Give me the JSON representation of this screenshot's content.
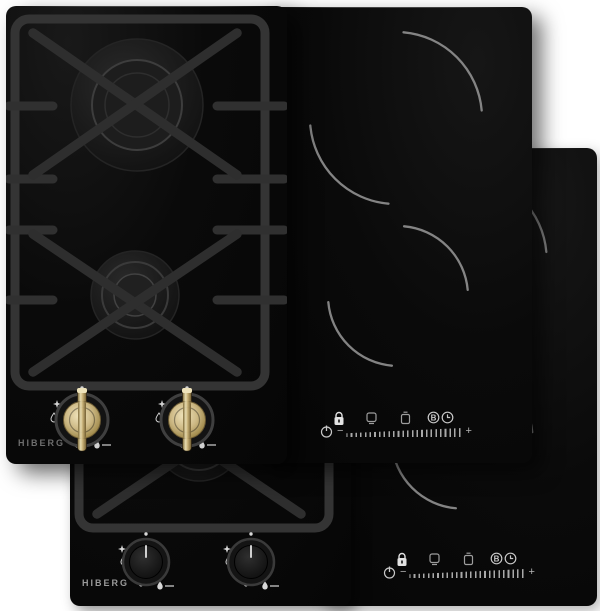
{
  "scene": {
    "background_color": "#ffffff",
    "layout": "two overlapping appliance sets, front pair upper-left, back pair offset lower-right"
  },
  "products": {
    "front_gas_hob": {
      "brand": "HIBERG",
      "type": "domino gas hob",
      "burners": 2,
      "knob_style": "brass",
      "knob_markings": [
        "off-dot",
        "spark-star",
        "droplet",
        "low-flame-dots",
        "small-flame",
        "max-flame-dash"
      ]
    },
    "front_induction_hob": {
      "type": "domino induction hob",
      "zones": 2,
      "controls": {
        "boost_label": "B",
        "minus_label": "−",
        "plus_label": "+",
        "icons": [
          "lock-icon",
          "zone-pot-1-icon",
          "zone-pot-2-icon",
          "boost-icon",
          "timer-icon",
          "power-icon",
          "level-slider"
        ]
      }
    },
    "back_gas_hob": {
      "brand": "HIBERG",
      "type": "domino gas hob",
      "burners": 2,
      "knob_style": "black"
    },
    "back_induction_hob": {
      "type": "domino induction hob",
      "zones": 2,
      "controls": {
        "boost_label": "B",
        "minus_label": "−",
        "plus_label": "+",
        "icons": [
          "lock-icon",
          "zone-pot-1-icon",
          "zone-pot-2-icon",
          "boost-icon",
          "timer-icon",
          "power-icon",
          "level-slider"
        ]
      }
    }
  },
  "colors": {
    "panel_black": "#0a0a0a",
    "grate_gray": "#333333",
    "grate_top_highlight": "#8a8a8a",
    "zone_arc_gray": "#919191",
    "icon_gray": "#c8c8c8",
    "brass_accent": "#d3c193",
    "logo_gray_front": "#6d6d6d",
    "logo_gray_back": "#9a9a9a"
  }
}
